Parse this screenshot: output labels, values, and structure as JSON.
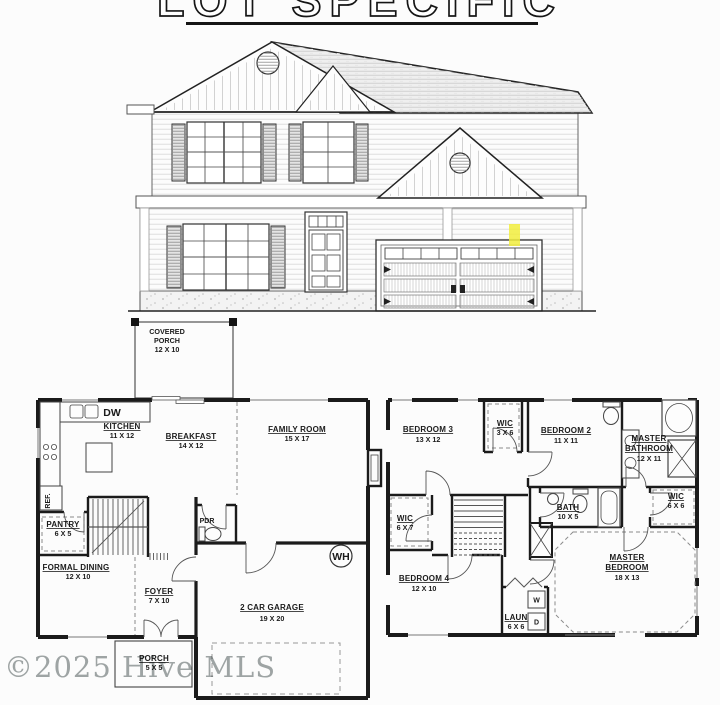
{
  "title": {
    "text": "LOT SPECIFIC"
  },
  "watermark": {
    "text": "©2025 Hive MLS"
  },
  "colors": {
    "highlight": "#f1ed3d",
    "ink": "#1b1b1b",
    "watermark": "#a0a6a6"
  },
  "first_floor": {
    "covered_porch": {
      "line1": "COVERED",
      "line2": "PORCH",
      "dims": "12 X 10"
    },
    "kitchen": {
      "name": "KITCHEN",
      "dims": "11 X 12"
    },
    "dishwasher": "DW",
    "refrigerator": "REF.",
    "breakfast": {
      "name": "BREAKFAST",
      "dims": "14 X 12"
    },
    "family_room": {
      "name": "FAMILY ROOM",
      "dims": "15 X 17"
    },
    "pantry": {
      "name": "PANTRY",
      "dims": "6 X 5"
    },
    "formal_dining": {
      "name": "FORMAL DINING",
      "dims": "12 X 10"
    },
    "foyer": {
      "name": "FOYER",
      "dims": "7 X 10"
    },
    "powder_room": "PDR",
    "water_heater": "WH",
    "garage": {
      "name": "2 CAR GARAGE",
      "dims": "19 X 20"
    },
    "front_porch": {
      "name": "PORCH",
      "dims": "5 X 5"
    }
  },
  "second_floor": {
    "bedroom_3": {
      "name": "BEDROOM 3",
      "dims": "13 X 12"
    },
    "wic_bedroom_3": {
      "name": "WIC",
      "dims": "3 X 6"
    },
    "bedroom_2": {
      "name": "BEDROOM 2",
      "dims": "11 X 11"
    },
    "master_bathroom": {
      "line1": "MASTER",
      "line2": "BATHROOM",
      "dims": "12 X 11"
    },
    "wic_master": {
      "name": "WIC",
      "dims": "6 X 6"
    },
    "bath": {
      "name": "BATH",
      "dims": "10 X 5"
    },
    "master_bedroom": {
      "line1": "MASTER",
      "line2": "BEDROOM",
      "dims": "18 X 13"
    },
    "wic_bedroom_4": {
      "name": "WIC",
      "dims": "6 X 7"
    },
    "bedroom_4": {
      "name": "BEDROOM 4",
      "dims": "12 X 10"
    },
    "laundry": {
      "name": "LAUN",
      "dims": "6 X 6"
    },
    "washer": "W",
    "dryer": "D"
  }
}
